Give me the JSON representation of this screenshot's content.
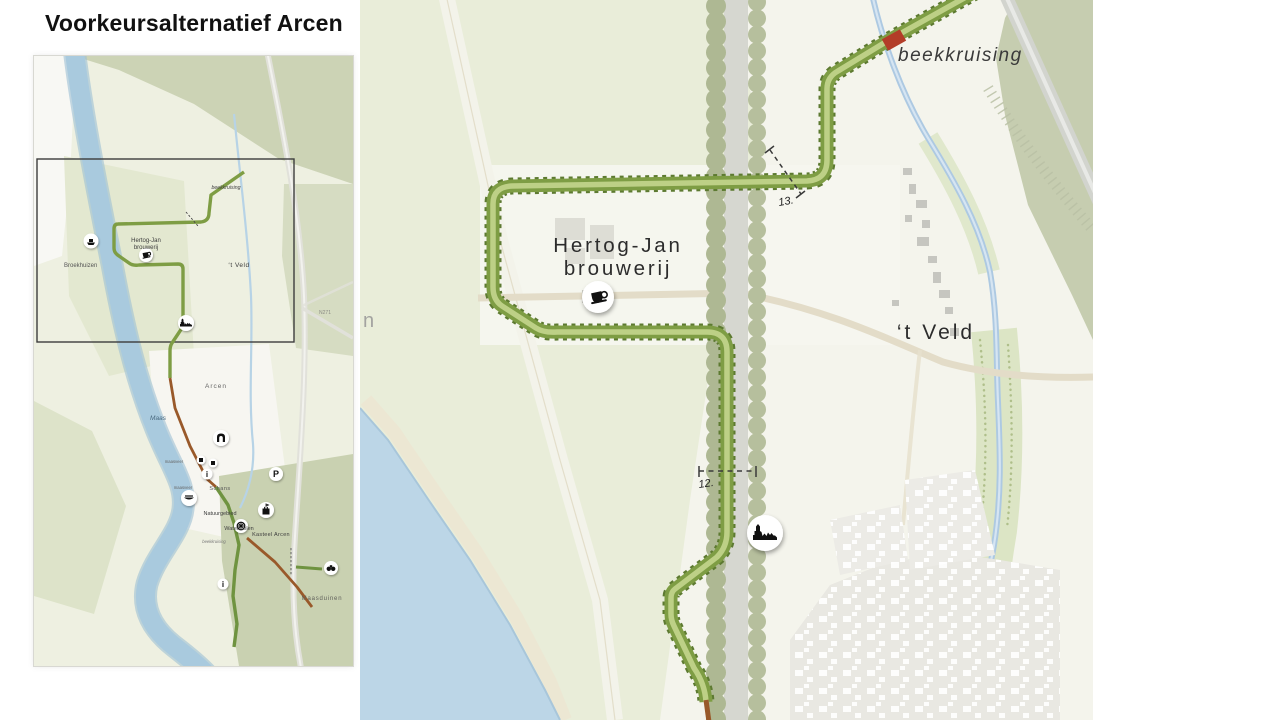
{
  "page": {
    "title": "Voorkeursalternatief Arcen"
  },
  "overview_map": {
    "labels": {
      "beekkruising_noord": "beekkruising",
      "hertog_jan_1": "Hertog-Jan",
      "hertog_jan_2": "brouwerij",
      "t_veld": "‘t Veld",
      "n271": "N271",
      "broekhuizen": "Broekhuizen",
      "arcen": "Arcen",
      "maas": "Maas",
      "maasveer_1": "maasveer",
      "maasveer_2": "maasveer",
      "schans": "Schans",
      "natuurgebied": "Natuurgebied",
      "watermolen": "Watermolen",
      "kasteel_arcen": "Kasteel Arcen",
      "beekkruising_zuid": "beekkruising",
      "maasduinen": "Maasduinen"
    },
    "icon_glyphs": {
      "parking": "P",
      "info_1": "i",
      "info_2": "i"
    },
    "icons": {
      "ferry": "ferry-icon",
      "brewery_cafe": "coffee-cup-icon",
      "village": "village-silhouette-icon",
      "gate": "gate-icon",
      "castle": "castle-tower-icon",
      "watermill": "watermill-wheel-icon",
      "boat": "rowboat-icon",
      "viewpoint": "binoculars-icon"
    }
  },
  "detail_map": {
    "labels": {
      "beekkruising": "beekkruising",
      "hertog_jan_1": "Hertog-Jan",
      "hertog_jan_2": "brouwerij",
      "t_veld": "‘t Veld",
      "edge_fragment": "n"
    },
    "markers": {
      "section_12": "12.",
      "section_13": "13."
    },
    "icons": {
      "brewery_cafe": "coffee-cup-icon",
      "village": "village-silhouette-icon"
    }
  },
  "colors": {
    "route_green": "#7e9d44",
    "route_green_light": "#bdd086",
    "route_green_dark": "#5d7a31",
    "route_brown": "#99592a",
    "crossing_red": "#b33d28",
    "water": "#adc9e2",
    "maas_water": "#a9cade",
    "sage": "#c6cdb0",
    "field": "#e7ecd6",
    "tree_green": "#aeb893",
    "road_beige": "#e3dcc8"
  }
}
